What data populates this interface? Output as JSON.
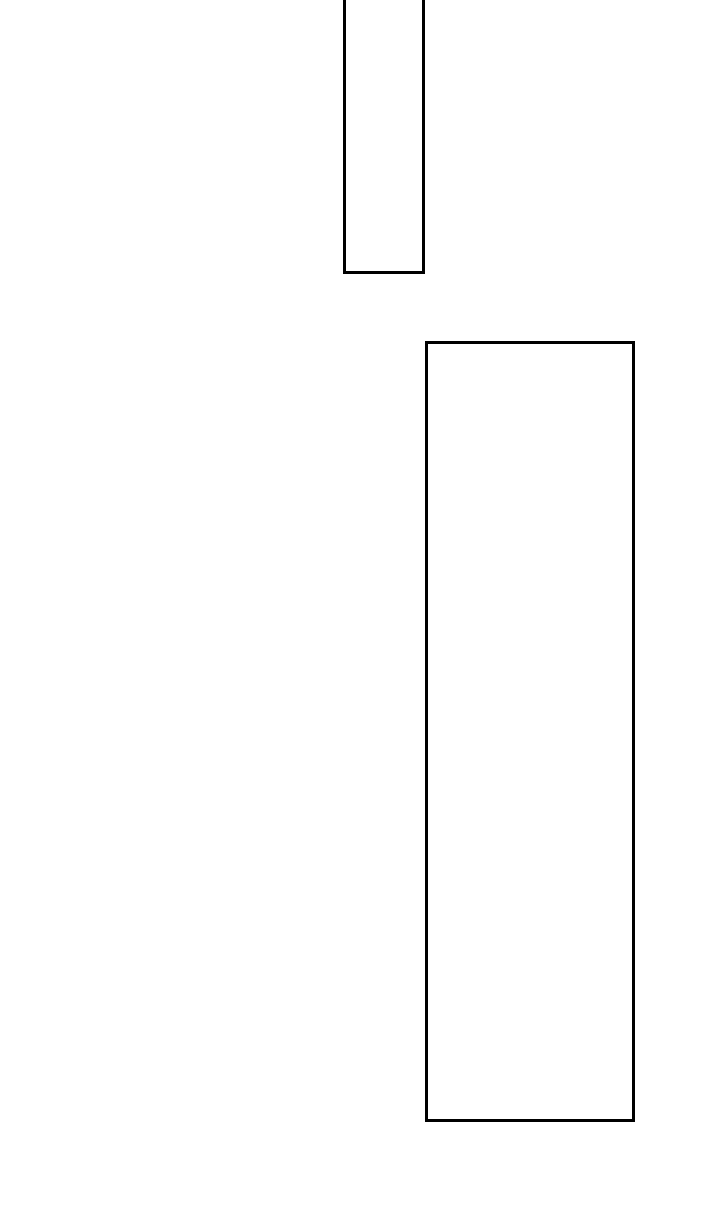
{
  "canvas": {
    "width": 720,
    "height": 1212,
    "background": "#ffffff"
  },
  "shapes": [
    {
      "id": "top-rectangle",
      "type": "rect",
      "x": 343,
      "y": -8,
      "width": 82,
      "height": 282,
      "stroke": "#000000",
      "stroke_width": 3,
      "fill": "#ffffff",
      "note": "top edge extends above viewport; only left, right and bottom borders visible"
    },
    {
      "id": "tall-rectangle",
      "type": "rect",
      "x": 425,
      "y": 341,
      "width": 210,
      "height": 781,
      "stroke": "#000000",
      "stroke_width": 3,
      "fill": "#ffffff",
      "note": "fully visible outlined rectangle"
    }
  ]
}
